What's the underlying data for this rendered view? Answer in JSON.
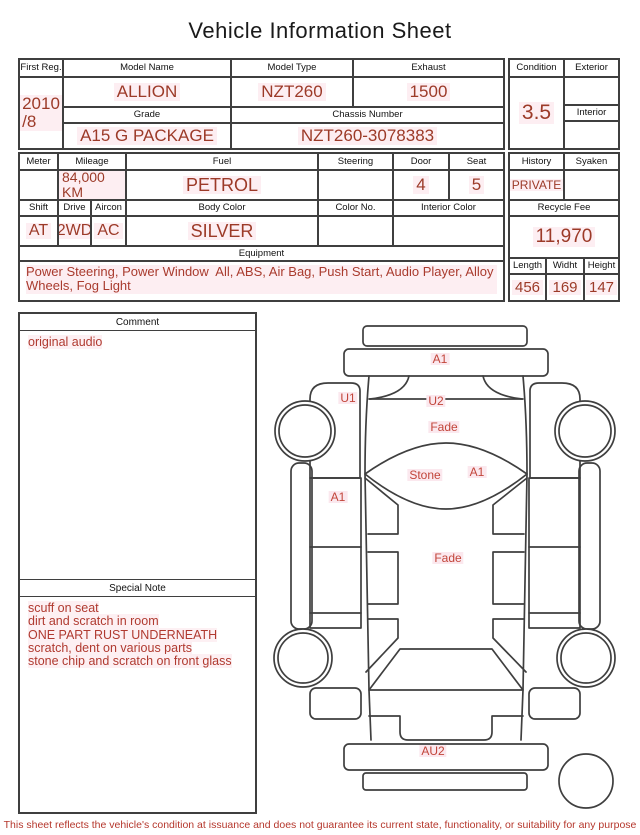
{
  "title": "Vehicle Information Sheet",
  "table1": {
    "first_reg": {
      "label": "First Reg.",
      "value": "2010\n/8"
    },
    "model_name": {
      "label": "Model Name",
      "value": "ALLION"
    },
    "model_type": {
      "label": "Model Type",
      "value": "NZT260"
    },
    "exhaust": {
      "label": "Exhaust",
      "value": "1500"
    },
    "grade": {
      "label": "Grade",
      "value": "A15 G PACKAGE"
    },
    "chassis_number": {
      "label": "Chassis Number",
      "value": "NZT260-3078383"
    },
    "condition": {
      "label": "Condition",
      "value": "3.5"
    },
    "exterior": {
      "label": "Exterior",
      "value": ""
    },
    "interior": {
      "label": "Interior",
      "value": ""
    }
  },
  "table2": {
    "meter": {
      "label": "Meter",
      "value": ""
    },
    "mileage": {
      "label": "Mileage",
      "value": "84,000 KM"
    },
    "fuel": {
      "label": "Fuel",
      "value": "PETROL"
    },
    "steering": {
      "label": "Steering",
      "value": ""
    },
    "door": {
      "label": "Door",
      "value": "4"
    },
    "seat": {
      "label": "Seat",
      "value": "5"
    },
    "shift": {
      "label": "Shift",
      "value": "AT"
    },
    "drive": {
      "label": "Drive",
      "value": "2WD"
    },
    "aircon": {
      "label": "Aircon",
      "value": "AC"
    },
    "body_color": {
      "label": "Body Color",
      "value": "SILVER"
    },
    "color_no": {
      "label": "Color No.",
      "value": ""
    },
    "interior_color": {
      "label": "Interior Color",
      "value": ""
    },
    "equipment": {
      "label": "Equipment",
      "value": "Power Steering, Power Window  All, ABS, Air Bag, Push Start, Audio Player, Alloy Wheels, Fog Light"
    },
    "history": {
      "label": "History",
      "value": "PRIVATE"
    },
    "syaken": {
      "label": "Syaken",
      "value": ""
    },
    "recycle_fee": {
      "label": "Recycle Fee",
      "value": "11,970"
    },
    "length": {
      "label": "Length",
      "value": "456"
    },
    "width": {
      "label": "Widht",
      "value": "169"
    },
    "height": {
      "label": "Height",
      "value": "147"
    }
  },
  "comment": {
    "label": "Comment",
    "value": "original audio"
  },
  "special_note": {
    "label": "Special Note",
    "lines": [
      "scuff on seat",
      "dirt and scratch in room",
      "ONE PART RUST UNDERNEATH",
      "scratch, dent on various parts",
      "stone chip and scratch on front glass"
    ]
  },
  "diagram": {
    "markers": [
      {
        "label": "A1",
        "x": 168,
        "y": 47
      },
      {
        "label": "U1",
        "x": 76,
        "y": 86
      },
      {
        "label": "U2",
        "x": 164,
        "y": 89
      },
      {
        "label": "Fade",
        "x": 172,
        "y": 115
      },
      {
        "label": "Stone",
        "x": 153,
        "y": 163
      },
      {
        "label": "A1",
        "x": 205,
        "y": 160
      },
      {
        "label": "A1",
        "x": 66,
        "y": 185
      },
      {
        "label": "Fade",
        "x": 176,
        "y": 246
      },
      {
        "label": "AU2",
        "x": 161,
        "y": 439
      }
    ]
  },
  "footer": "This sheet reflects the vehicle's condition at issuance and does not guarantee its current state, functionality, or suitability for any purpose",
  "colors": {
    "value_red": "#9c3a28",
    "note_red": "#b03a30",
    "marker_red": "#c2453a",
    "line": "#3f3f3f"
  }
}
